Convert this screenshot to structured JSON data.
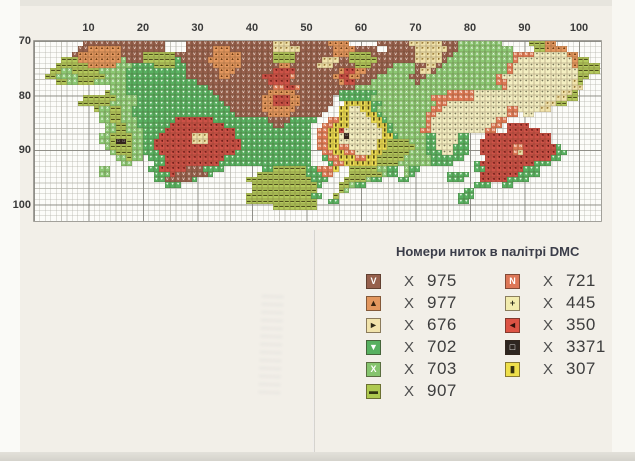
{
  "page": {
    "background": "#f2efe8"
  },
  "chart": {
    "columns": 104,
    "rows": 33,
    "major_every": 10,
    "axis_top_labels": [
      "10",
      "20",
      "30",
      "40",
      "50",
      "60",
      "70",
      "80",
      "90",
      "100"
    ],
    "axis_left_labels": [
      "70",
      "80",
      "90",
      "100"
    ],
    "palette": {
      "V": {
        "dmc": "975",
        "color": "#96604c",
        "glyph": "V",
        "glyph_color": "#f3e4db"
      },
      "A": {
        "dmc": "977",
        "color": "#e3975e",
        "glyph": "▲",
        "glyph_color": "#6b3c14"
      },
      "R": {
        "dmc": "676",
        "color": "#f1e3ab",
        "glyph": "►",
        "glyph_color": "#8a6a28"
      },
      "D": {
        "dmc": "702",
        "color": "#57b060",
        "glyph": "▼",
        "glyph_color": "#eaf6e8"
      },
      "X": {
        "dmc": "703",
        "color": "#8bc873",
        "glyph": "X",
        "glyph_color": "#f2fbef"
      },
      "H": {
        "dmc": "907",
        "color": "#b3c95c",
        "glyph": "▬",
        "glyph_color": "#4f501c"
      },
      "N": {
        "dmc": "721",
        "color": "#df7a55",
        "glyph": "N",
        "glyph_color": "#fdf1e8"
      },
      "P": {
        "dmc": "445",
        "color": "#f4efc2",
        "glyph": "+",
        "glyph_color": "#4b4a33"
      },
      "L": {
        "dmc": "350",
        "color": "#cd5247",
        "glyph": "◄",
        "glyph_color": "#5e1511"
      },
      "B": {
        "dmc": "3371",
        "color": "#33251d",
        "glyph": "□",
        "glyph_color": "#f5f5f5"
      },
      "I": {
        "dmc": "307",
        "color": "#eedf52",
        "glyph": "▮",
        "glyph_color": "#4f4413"
      }
    },
    "pattern_rows": [
      ".........VVVVVVVVVVVVVVV....VVVVVVVVVVVVVVVVRRRVVVVVVVAAAA.....VVVVVVRRRRRRVVVXXXXXXXX.....HHHAA......",
      "........VVAAAAAAVVVVVVVV....VVVVVAAAVVVVVVVVRRRRRVVVVVVAAAAVVVV..VVVVVRRRRRRVVXXXXXXXXXX....HHAAAA....",
      ".......VAAAAAAAAVVVVHHHHHHVVVVVVVAAAAAVVVVVVHHHHVVVVVVVAAAHHHHVVVVVVVVRRRRRVVXXXXXXXXXXXNNNNPPPPPPAA....",
      ".....HHHAAAAAAAAXVVVHHHHHHDVVVVVAAAAAAVVVVVVHHHHVVVVVRRRVVHHHHHVVVVVVVRRRRRVXXXXXXXXXXXXNPPPPPPPPPPAHH..",
      "....HHHHHHAAAAAXXXDDDDHHHHDDVVVVVAAAAAVVVVVVVAAVVVVVRRRVVVVHHHVVVVXXXXVVRRVXXXXXXXXXXXXNPPPPPPPPPPPAHHHH",
      "...HHXXHHHHHXXXXXDDDDDDDDDDDVVVVVVAAAVVVVVVVLLLLVVVVVVVVALLAAVVVVXXXXXVRRVXXXXXXXXXXXXXNPPPPPPPPPPPPHHHH",
      "..HHXXXXHHHHHXXXXDDDDDDDDDDDVVVVVVAAVVVVVVLLLLLNVVVVVVVALLAAVVVXXXXXXVVVXXXXXXXXXXXXXNPPPPPPPPPPPPPPHH..",
      "....HHXXHHHXXXXXXDDDDDDDDDDDDDVVVVVVVVVVVVVLLLLVVVVVVVVVALLVVVXXXXXXXXVXXXXXXXXXXXXXXNNPPPPPPPPPPPPRH...",
      "..............XXXDDDDDDDDDDDDDDDVVVVVVVVVVVVNNLLNVVVVVVVVVVXXXXXXXXXXXXXXXXXXXXXXXXXXXNPPPPPPPPPPPPRR....",
      ".............HXXXDDDDDDDDDDDDDDDDVVVVVVVVVVAAAAAVVVVVVVVDDDDDDDXXXXXXXXXXXXXNNNNNPPPPPPPPPPPPPPPPRRH....",
      ".........HHHHHHXXXXDDDDDDDDDDDDDDDVVVVVVVVAALLLAAVVVVVV.DDDDDDXXXXXXXXXXXNNNNNNNNPPPPPPPPPPPPPPPRRHH....",
      "........HHHHHHXXXXXDDDDDDDDDDDDDDDDVVVVVVVAALLLAAVVVVVV..IIIIIDDXXXXXXXXXXNNPPPPPPPPPPPPPPPPPPRRHH......",
      "...........HXXHHXXDDDDDDDDDDDDDDDDDDVVVVVVAAAAAAVVVVVV..IIPPIIDXXXXXXXXXXNNPPPPPPPPPPPPNNPPPPRR........",
      "............XXHHXXDDDDDDDDDDDDDDDDDDDVVVVVVAAAAVVVVVV...IIPPPIIDXXXXXXXXNNPPPPPPPPPPPPPNN.PP............",
      "............XXHHXXXDDDDDDDLLLLLLLDDDDDDDDDDVVVVDDDDD..NNIIPPPPIIDXXXXXXXNPPPPPPPPPPPPNN................",
      ".............XXHHXXDDDDDDLLLLLLLLLLDDDDDDDDDVVDDDDD..NNIIIPPPPPIIDXXXXXXNPPPPPPPPPPPNN.LLLL.............",
      ".............XXHHXXXDDDDLLLLLLLLLLLLLDDDDDDDDDDDDDD.NNIILPPPPPPPIDXXXXXNNPPPPPPPPPPNN..LLLLLL...........",
      "............XXHHHHXXDDDLLLLLLRRRLLLLLDDDDDDDDDDDDDD.NNIIPBPPPPPPIIDXXXXXDDPPPPDD...LLLLLLLLLLLL.........",
      "............XXHBBHXXDDLLLLLLLRRRLLLLLLDDDDDDDDDDDDD.NNIIPPPPPPPIIHHHHXXXDDPPPPDD..LLLLLLLLLLLLL.........",
      ".............XHHHHXXDDLLLLLLLLLLLLLLLLDDDDDDDDDDDDD.NNIINNPPPPPIIHHHHHXXDDPPPDDD..LLLLLLNNLLLLLLD.......",
      "..............XHHHXXDDDLLLLLLLLLLLLLLDDDDDDDDDDDDDD..NNIINNPPPIIHHHHHXXXDDDPPDDD..LLLLLLNRLLLLLLDD......",
      "...............XXHXX.DDDLLLLLLLLLLLDDDDDDDDDDDDDDDD..DNNIIINNIIHHHHHXXXXXDDDDDD....LLLLLLLLLLLLDD.......",
      "................XX....DDLLLLLLLLLLDDDDDDDDDDDDDDDDD...DNNIIIIIIHHHHXXXXXXDDDD....DLLLLLLLLLLDDD.........",
      "............XX.......DDLLLLLVVVDDDD.......DDHHHHHHDDNNNI..HHHHHXXDD.XDD..........DDLLLLLLLDDD...........",
      "............XX........DDDLVVVVVVD........HHHHHHHHHDDDNN...HHHHHHXDD.XD......DDDD..LLLLLLLDDDD...........",
      "......................DDVVVVVD.........HHHHHHHHHHHHDDD...HHHHXDD...DD.......DDD...LLLLLDDDD.............",
      "........................DDD.............HHHHHHHHHHHHD...HHXDD....................DDD..DD...............",
      "........................................HHHHHHHHHHHH....HX.....................DD.......................",
      ".......................................HHHHHHHHHHHHDD..H......................DDD.......................",
      ".......................................HHHHHHHHHHHHH..DD......................DD........................",
      "............................................HHHHHHHH....................................................",
      ".........................................................................................................",
      "........................................................................................................."
    ]
  },
  "legend": {
    "title": "Номери ниток в палітрі DMC",
    "multiplier": "X",
    "left": [
      {
        "symbol": "V",
        "chip_color": "#96604c",
        "symbol_color": "#ffffff",
        "code": "975"
      },
      {
        "symbol": "▲",
        "chip_color": "#e3975e",
        "symbol_color": "#3a2510",
        "code": "977"
      },
      {
        "symbol": "►",
        "chip_color": "#f1e3ab",
        "symbol_color": "#2e2a18",
        "code": "676"
      },
      {
        "symbol": "▼",
        "chip_color": "#57b060",
        "symbol_color": "#ffffff",
        "code": "702"
      },
      {
        "symbol": "X",
        "chip_color": "#85c46d",
        "symbol_color": "#ffffff",
        "code": "703"
      },
      {
        "symbol": "▬",
        "chip_color": "#aec94f",
        "symbol_color": "#333611",
        "code": "907"
      }
    ],
    "right": [
      {
        "symbol": "N",
        "chip_color": "#dd7757",
        "symbol_color": "#ffffff",
        "code": "721"
      },
      {
        "symbol": "+",
        "chip_color": "#f2ecae",
        "symbol_color": "#2e2d1e",
        "code": "445"
      },
      {
        "symbol": "◄",
        "chip_color": "#dd5344",
        "symbol_color": "#33100a",
        "code": "350"
      },
      {
        "symbol": "□",
        "chip_color": "#2e2620",
        "symbol_color": "#ffffff",
        "code": "3371"
      },
      {
        "symbol": "▮",
        "chip_color": "#eedf4a",
        "symbol_color": "#35300e",
        "code": "307"
      }
    ]
  }
}
